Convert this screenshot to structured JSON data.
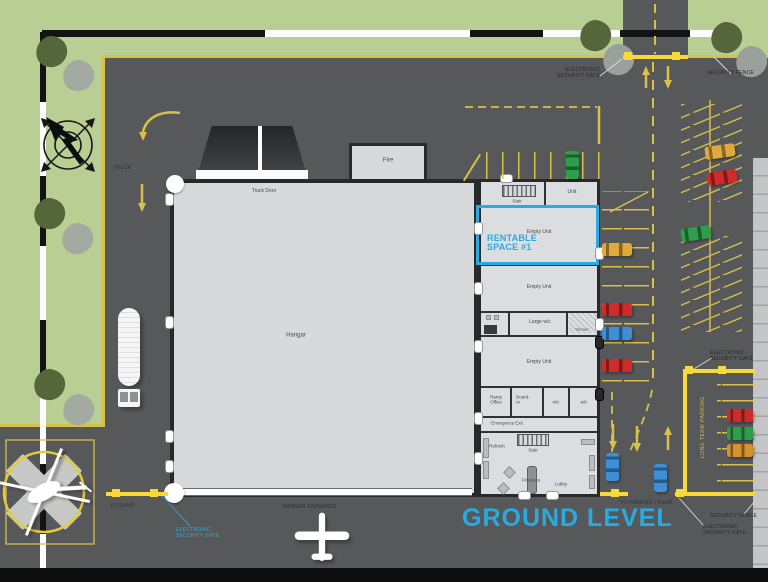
{
  "title": "GROUND LEVEL",
  "palette": {
    "accent_cyan": "#29abe2",
    "asphalt": "#57585a",
    "grass": "#b9ce92",
    "marking_yellow": "#d8c049",
    "gate_yellow": "#f7d93a",
    "building_gray": "#d8d9db"
  },
  "labels": {
    "truck": "TRUCK",
    "to_ramp": "TO RAMP",
    "hangar_entrance": "HANGAR ENTRANCE",
    "to_parking_rear": "TO PARKING / REAR",
    "security_fence": "SECURITY FENCE",
    "electronic_line1": "ELECTRONIC",
    "electronic_line2": "SECURITY GATE",
    "long_term_parking": "LONG TERM PARKING"
  },
  "building": {
    "hangar": "Hangar",
    "truck_door": "Truck Door",
    "fire": "Fire",
    "stair": "Stair",
    "unit": "Unit",
    "empty_unit": "Empty Unit",
    "large_wc": "Large w/c",
    "shower": "Shower",
    "ramp_office_l1": "Ramp",
    "ramp_office_l2": "Office",
    "boarder_l1": "Board-",
    "boarder_l2": "er",
    "wc": "w/c",
    "emergency_exit": "Emergency Exit",
    "refresh": "Refresh",
    "fireplace": "Fireplace",
    "lobby": "Lobby"
  },
  "rentable": {
    "line1": "RENTABLE",
    "line2": "SPACE #1"
  }
}
